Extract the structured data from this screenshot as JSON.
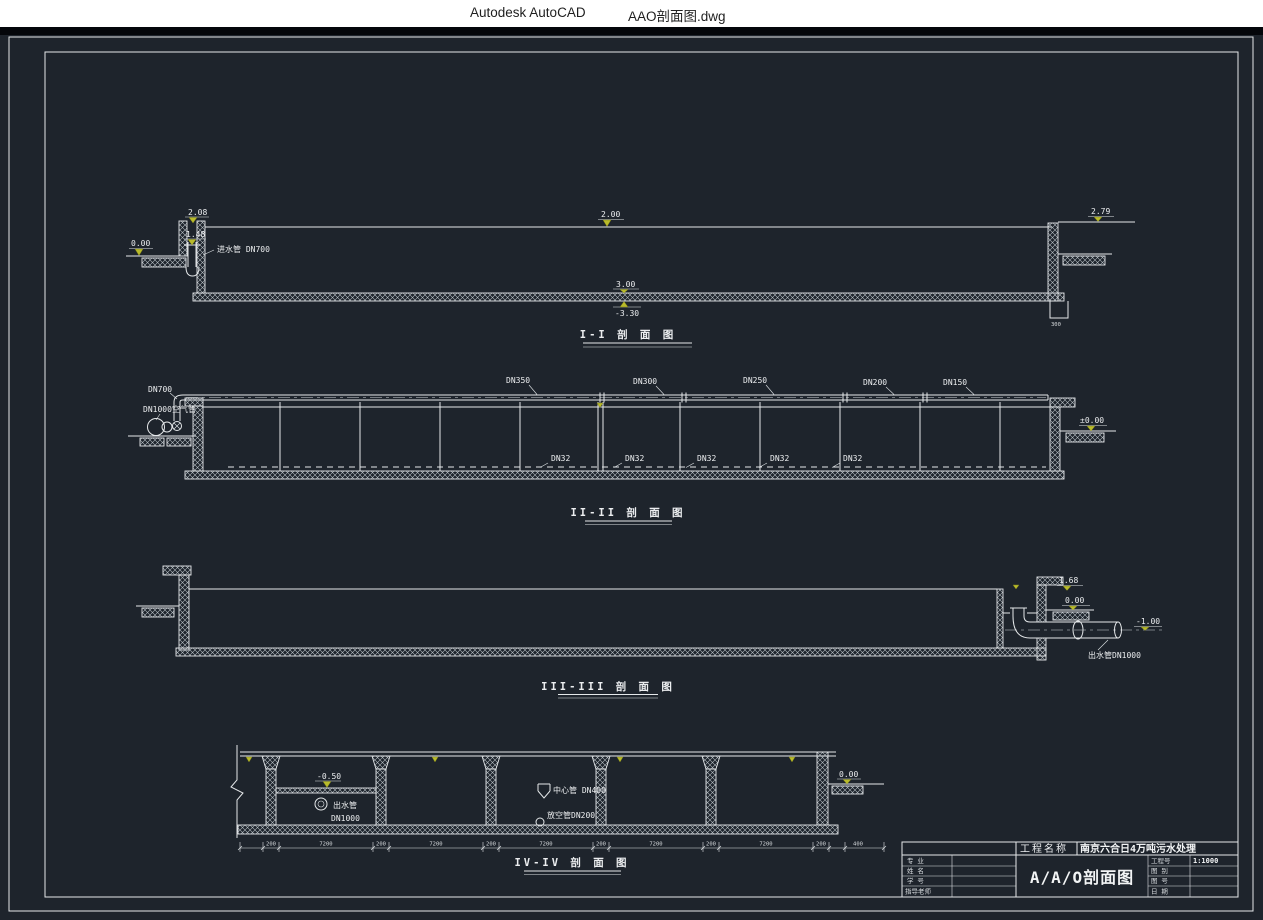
{
  "window": {
    "app": "Autodesk AutoCAD",
    "doc": "AAO剖面图.dwg"
  },
  "colors": {
    "canvas_bg": "#1e242c",
    "line": "#e5e8ea",
    "elevation_marker": "#b9bb2a",
    "titlebar_bg": "#ffffff"
  },
  "s1": {
    "title": "I-I 剖 面 图",
    "elev_top": "2.08",
    "elev_channel": "1.48",
    "elev_ground_left": "0.00",
    "inlet_label": "进水管 DN700",
    "elev_water": "2.00",
    "elev_top_right": "2.79",
    "elev_floor": "3.00",
    "elev_slab_bottom": "-3.30",
    "pit_dim": "300"
  },
  "s2": {
    "title": "II-II 剖 面 图",
    "inlet_air_main": "DN700",
    "blower_pipe": "DN1000",
    "air_pipe_label": "空气管",
    "top_pipes": [
      "DN350",
      "DN300",
      "DN250",
      "DN200",
      "DN150"
    ],
    "branch_pipes": [
      "DN32",
      "DN32",
      "DN32",
      "DN32",
      "DN32"
    ],
    "elev_ground_right": "±0.00"
  },
  "s3": {
    "title": "III-III 剖 面 图",
    "elev_wall_top": "1.68",
    "elev_ground": "0.00",
    "elev_pipe": "-1.00",
    "outlet_label": "出水管DN1000"
  },
  "s4": {
    "title": "IV-IV 剖 面 图",
    "elev_trough": "-0.50",
    "outlet_line1": "出水管",
    "outlet_line2": "DN1000",
    "center_pipe": "中心管 DN400",
    "drain_pipe": "放空管DN200",
    "elev_ground": "0.00",
    "dims": [
      "200",
      "7200",
      "200",
      "7200",
      "200",
      "7200",
      "200",
      "7200",
      "200",
      "7200",
      "200",
      "400"
    ]
  },
  "titleblock": {
    "project_label": "工程名称",
    "project_value": "南京六合日4万吨污水处理",
    "drawing_title": "A/A/O剖面图",
    "rows_left": [
      {
        "label": "专 业"
      },
      {
        "label": "姓 名"
      },
      {
        "label": "学 号"
      },
      {
        "label": "指导老师"
      }
    ],
    "rows_right": [
      {
        "label": "工程号",
        "value": "1:1000"
      },
      {
        "label": "图 别",
        "value": ""
      },
      {
        "label": "图 号",
        "value": ""
      },
      {
        "label": "日 期",
        "value": ""
      }
    ]
  }
}
